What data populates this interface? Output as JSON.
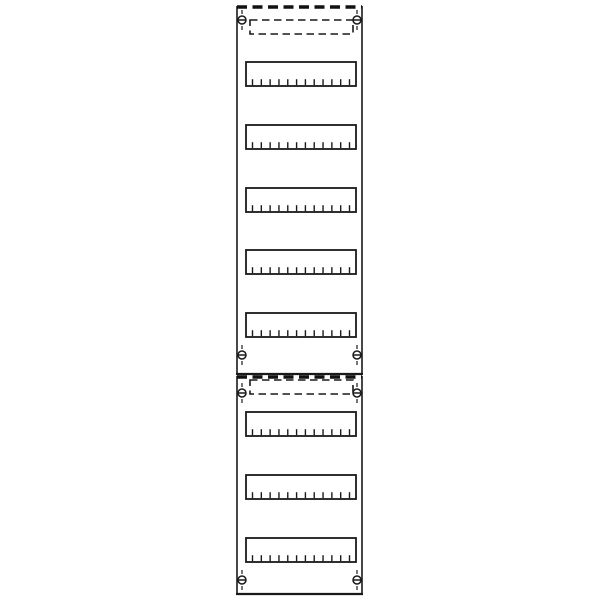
{
  "app": {
    "background_color": "#ffffff",
    "stroke_color": "#1a1a1a"
  },
  "diagram": {
    "type": "distribution-board-front-view",
    "description": "Two stacked distribution board fields with DIN module rows, mounting screws and dashed cover strips",
    "module_ticks_per_row": 12,
    "tick_height": 6,
    "tick_inset": 6.5,
    "panels": [
      {
        "id": "field-1",
        "frame": {
          "x": 237,
          "y": 7,
          "width": 125,
          "height": 367
        },
        "top_edge_style": "heavy-dashed",
        "cover_strip": {
          "x": 250,
          "y": 20,
          "width": 103,
          "height": 14
        },
        "screws": [
          {
            "cx": 242,
            "cy": 20
          },
          {
            "cx": 357,
            "cy": 20
          },
          {
            "cx": 242,
            "cy": 355
          },
          {
            "cx": 357,
            "cy": 355
          }
        ],
        "rows": [
          {
            "x": 246,
            "y": 62,
            "width": 110,
            "height": 24
          },
          {
            "x": 246,
            "y": 125,
            "width": 110,
            "height": 24
          },
          {
            "x": 246,
            "y": 188,
            "width": 110,
            "height": 24
          },
          {
            "x": 246,
            "y": 250,
            "width": 110,
            "height": 24
          },
          {
            "x": 246,
            "y": 313,
            "width": 110,
            "height": 24
          }
        ]
      },
      {
        "id": "field-2",
        "frame": {
          "x": 237,
          "y": 377,
          "width": 125,
          "height": 217
        },
        "top_edge_style": "heavy-dashed",
        "cover_strip": {
          "x": 250,
          "y": 380,
          "width": 103,
          "height": 14
        },
        "screws": [
          {
            "cx": 242,
            "cy": 393
          },
          {
            "cx": 357,
            "cy": 393
          },
          {
            "cx": 242,
            "cy": 580
          },
          {
            "cx": 357,
            "cy": 580
          }
        ],
        "rows": [
          {
            "x": 246,
            "y": 412,
            "width": 110,
            "height": 24
          },
          {
            "x": 246,
            "y": 475,
            "width": 110,
            "height": 24
          },
          {
            "x": 246,
            "y": 538,
            "width": 110,
            "height": 24
          }
        ]
      }
    ]
  }
}
